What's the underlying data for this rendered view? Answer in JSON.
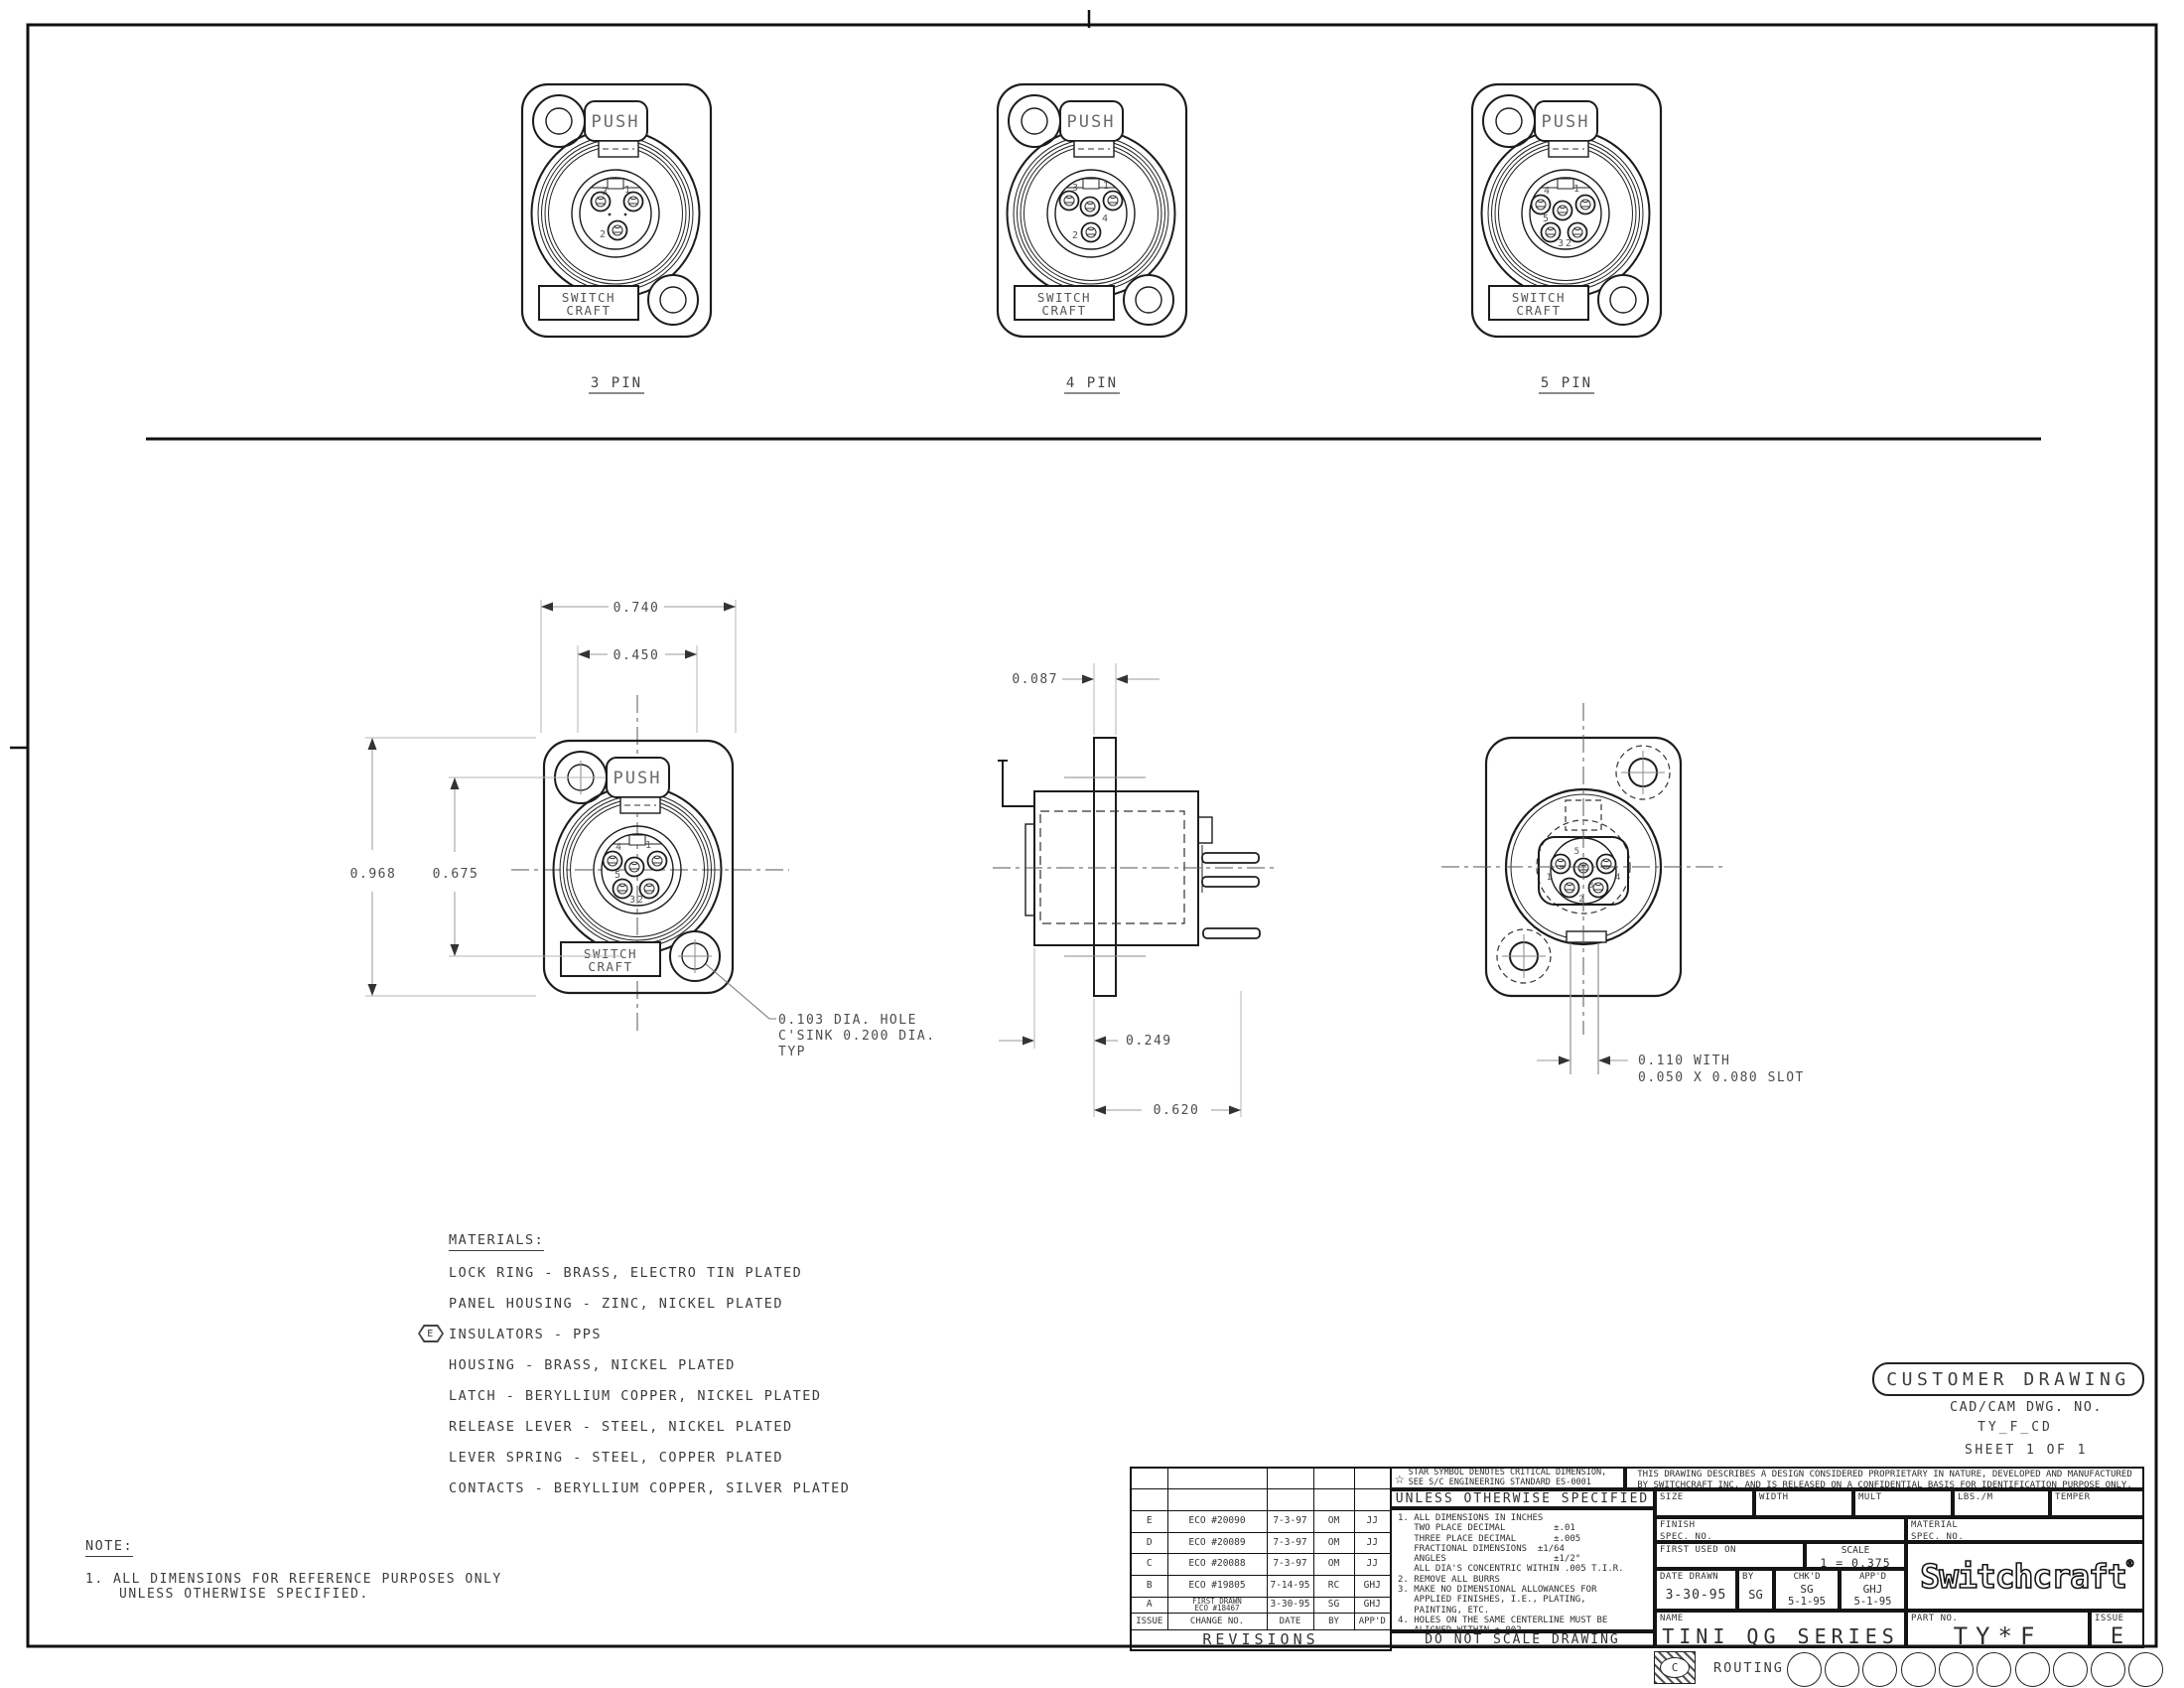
{
  "page": {
    "bg": "#ffffff",
    "line": "#1c1c1c"
  },
  "views": {
    "pin3": {
      "label": "3 PIN",
      "push": "PUSH",
      "brand1": "SWITCH",
      "brand2": "CRAFT",
      "p1": "1",
      "p2": "2",
      "p3": "3"
    },
    "pin4": {
      "label": "4 PIN",
      "push": "PUSH",
      "brand1": "SWITCH",
      "brand2": "CRAFT",
      "p1": "1",
      "p2": "2",
      "p3": "3",
      "p4": "4"
    },
    "pin5": {
      "label": "5 PIN",
      "push": "PUSH",
      "brand1": "SWITCH",
      "brand2": "CRAFT",
      "p1": "1",
      "p2": "2",
      "p3": "3",
      "p4": "4",
      "p5": "5"
    },
    "front": {
      "push": "PUSH",
      "brand1": "SWITCH",
      "brand2": "CRAFT",
      "p1": "1",
      "p2": "2",
      "p3": "3",
      "p4": "4",
      "p5": "5",
      "dim_width": "0.740",
      "dim_latch": "0.450",
      "dim_height": "0.968",
      "dim_holes": "0.675",
      "callout_line1": "0.103 DIA. HOLE",
      "callout_line2": "C'SINK 0.200 DIA.",
      "callout_line3": "TYP"
    },
    "side": {
      "dim_panel": "0.087",
      "dim_front": "0.249",
      "dim_depth": "0.620"
    },
    "rear": {
      "p1": "1",
      "p2": "2",
      "p3": "3",
      "p4": "4",
      "p5": "5",
      "callout_line1": "0.110 WITH",
      "callout_line2": "0.050 X 0.080 SLOT"
    }
  },
  "materials": {
    "title": "MATERIALS:",
    "items": [
      {
        "flag": "",
        "text": "LOCK RING - BRASS, ELECTRO TIN PLATED"
      },
      {
        "flag": "",
        "text": "PANEL HOUSING - ZINC, NICKEL PLATED"
      },
      {
        "flag": "E",
        "text": "INSULATORS - PPS"
      },
      {
        "flag": "",
        "text": "HOUSING - BRASS, NICKEL PLATED"
      },
      {
        "flag": "",
        "text": "LATCH - BERYLLIUM COPPER, NICKEL PLATED"
      },
      {
        "flag": "",
        "text": "RELEASE LEVER - STEEL, NICKEL PLATED"
      },
      {
        "flag": "",
        "text": "LEVER SPRING - STEEL, COPPER PLATED"
      },
      {
        "flag": "",
        "text": "CONTACTS - BERYLLIUM COPPER, SILVER PLATED"
      }
    ]
  },
  "note": {
    "title": "NOTE:",
    "line1": "1. ALL DIMENSIONS FOR REFERENCE PURPOSES ONLY",
    "line2": "UNLESS OTHERWISE SPECIFIED."
  },
  "stamp": {
    "title": "CUSTOMER DRAWING",
    "cad_label": "CAD/CAM DWG. NO.",
    "cad_number": "TY_F_CD",
    "sheet": "SHEET 1 OF 1"
  },
  "revisions": {
    "title": "REVISIONS",
    "headers": [
      "ISSUE",
      "CHANGE NO.",
      "DATE",
      "BY",
      "APP'D"
    ],
    "rows": [
      [
        "E",
        "ECO #20090",
        "7-3-97",
        "OM",
        "JJ"
      ],
      [
        "D",
        "ECO #20089",
        "7-3-97",
        "OM",
        "JJ"
      ],
      [
        "C",
        "ECO #20088",
        "7-3-97",
        "OM",
        "JJ"
      ],
      [
        "B",
        "ECO #19805",
        "7-14-95",
        "RC",
        "GHJ"
      ],
      [
        "A",
        "FIRST DRAWN\nECO #18467",
        "3-30-95",
        "SG",
        "GHJ"
      ]
    ]
  },
  "tolerance": {
    "star_line1": "STAR SYMBOL DENOTES CRITICAL DIMENSION,",
    "star_line2": "SEE S/C ENGINEERING STANDARD ES-0001",
    "header": "UNLESS OTHERWISE SPECIFIED",
    "body": "1. ALL DIMENSIONS IN INCHES\n   TWO PLACE DECIMAL         ±.01\n   THREE PLACE DECIMAL       ±.005\n   FRACTIONAL DIMENSIONS  ±1/64\n   ANGLES                    ±1/2°\n   ALL DIA'S CONCENTRIC WITHIN .005 T.I.R.\n2. REMOVE ALL BURRS\n3. MAKE NO DIMENSIONAL ALLOWANCES FOR\n   APPLIED FINISHES, I.E., PLATING,\n   PAINTING, ETC.\n4. HOLES ON THE SAME CENTERLINE MUST BE\n   ALIGNED WITHIN ±.002",
    "footer": "DO NOT SCALE DRAWING"
  },
  "title_block": {
    "proprietary_line1": "THIS DRAWING DESCRIBES A DESIGN CONSIDERED PROPRIETARY IN NATURE, DEVELOPED AND MANUFACTURED",
    "proprietary_line2": "BY SWITCHCRAFT INC. AND IS RELEASED ON A CONFIDENTIAL BASIS FOR IDENTIFICATION PURPOSE ONLY.",
    "size_label": "SIZE",
    "width_label": "WIDTH",
    "mult_label": "MULT",
    "lbs_label": "LBS./M",
    "temper_label": "TEMPER",
    "finish_label": "FINISH",
    "finish_spec_label": "SPEC. NO.",
    "material_label": "MATERIAL",
    "material_spec_label": "SPEC. NO.",
    "first_used_label": "FIRST USED ON",
    "scale_label": "SCALE",
    "scale_value": "1 = 0.375",
    "date_drawn_label": "DATE DRAWN",
    "date_drawn": "3-30-95",
    "by_label": "BY",
    "by": "SG",
    "chkd_label": "CHK'D",
    "chkd_by": "SG",
    "chkd_date": "5-1-95",
    "appd_label": "APP'D",
    "appd_by": "GHJ",
    "appd_date": "5-1-95",
    "logo": "Switchcraft",
    "logo_reg": "®",
    "name_label": "NAME",
    "name": "TINI QG SERIES",
    "part_label": "PART NO.",
    "part_number": "TY*F",
    "issue_label": "ISSUE",
    "issue": "E"
  },
  "routing": {
    "corner_mark": "C",
    "label": "ROUTING"
  }
}
